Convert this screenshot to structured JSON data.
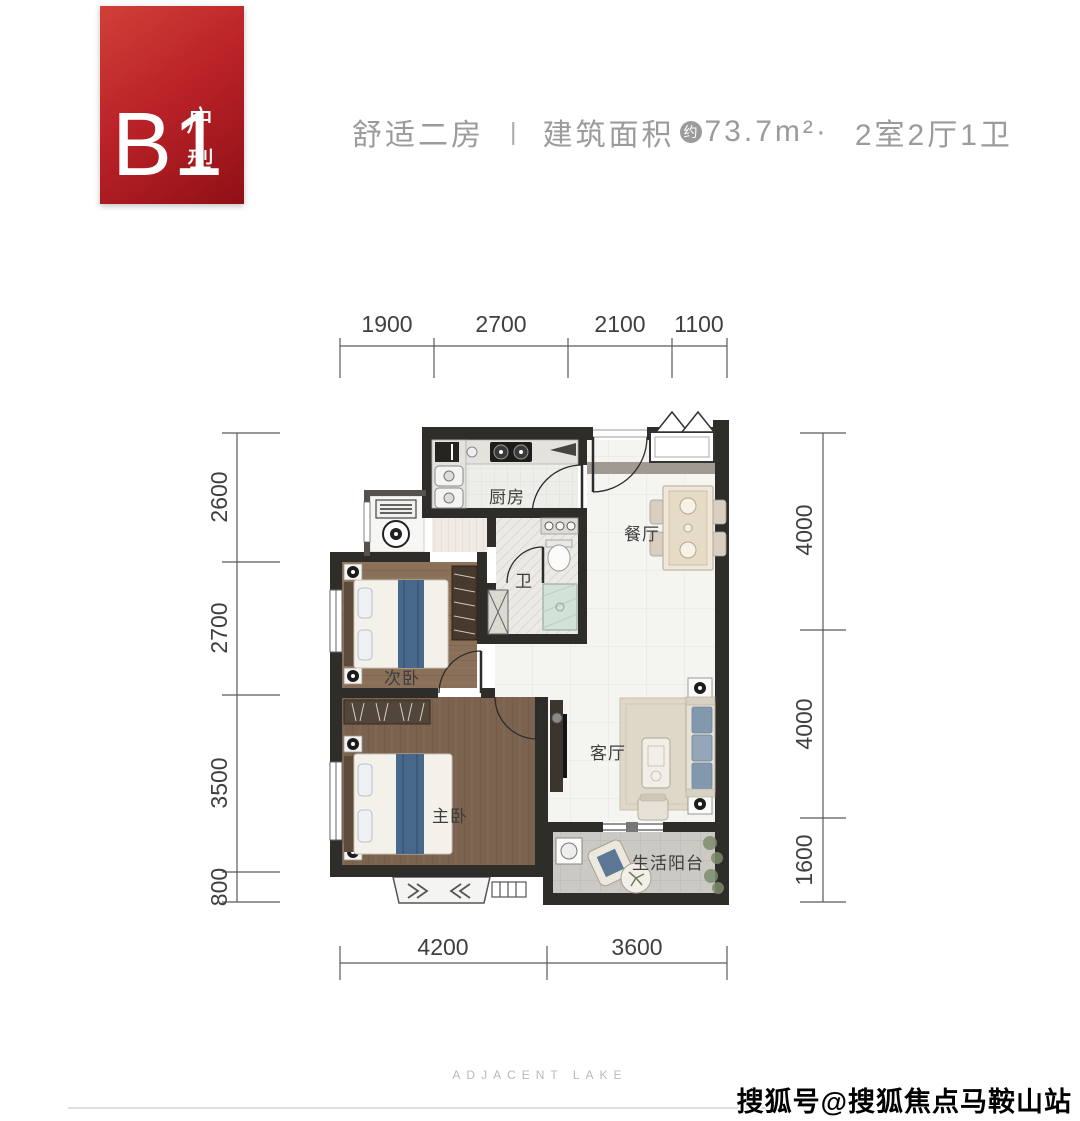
{
  "badge": {
    "code": "B1",
    "suffix": "户型"
  },
  "header": {
    "tagline": "舒适二房",
    "separator": "|",
    "area_label": "建筑面积",
    "area_approx": "约",
    "area_value": "73.7m²·",
    "layout": "2室2厅1卫"
  },
  "plan": {
    "rooms": {
      "kitchen": "厨房",
      "dining": "餐厅",
      "bath": "卫",
      "bedroom2": "次卧",
      "master": "主卧",
      "living": "客厅",
      "balcony": "生活阳台"
    },
    "dims": {
      "top": [
        "1900",
        "2700",
        "2100",
        "1100"
      ],
      "left": [
        "2600",
        "2700",
        "3500",
        "800"
      ],
      "right": [
        "4000",
        "4000",
        "1600"
      ],
      "bottom": [
        "4200",
        "3600"
      ]
    }
  },
  "footer": {
    "brand": "ADJACENT  LAKE"
  },
  "watermark": {
    "text": "搜狐号@搜狐焦点马鞍山站"
  },
  "colors": {
    "badge_red": "#b41f24",
    "wall": "#2f2d2a",
    "wood_master": "#7c6350",
    "wood_bedroom2": "#8a7058",
    "tile": "#f4f4f1",
    "balcony_tile": "#cbc9c4",
    "accent_blue": "#48688c",
    "header_gray": "#9b9b9b"
  }
}
